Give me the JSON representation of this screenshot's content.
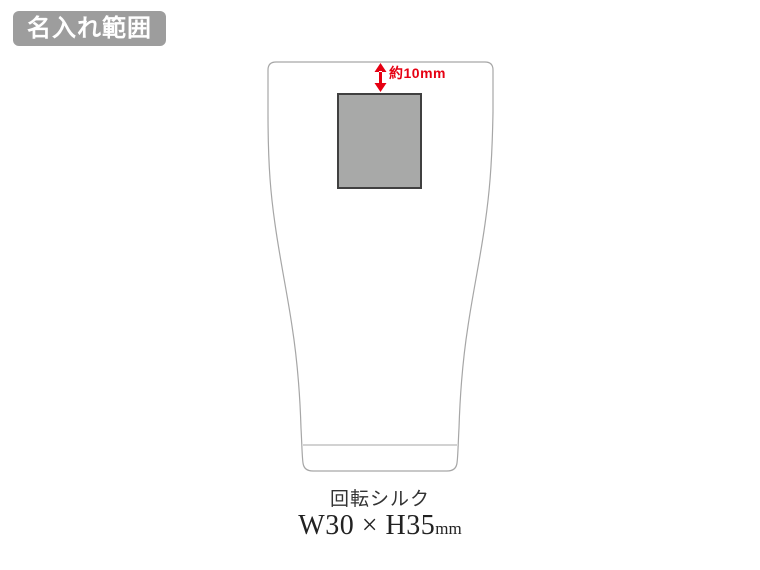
{
  "page": {
    "background_color": "#ffffff"
  },
  "badge": {
    "label": "名入れ範囲",
    "bg_color": "#9d9d9d",
    "text_color": "#ffffff"
  },
  "diagram": {
    "product_shape": "tumbler",
    "outline_color": "#a6a6a6",
    "print_area": {
      "fill_color": "#a8a9a8",
      "border_color": "#404040"
    },
    "annotation": {
      "label": "約10mm",
      "color": "#e60012"
    }
  },
  "caption": {
    "method": "回転シルク",
    "size": "W30 × H35",
    "unit": "mm"
  }
}
